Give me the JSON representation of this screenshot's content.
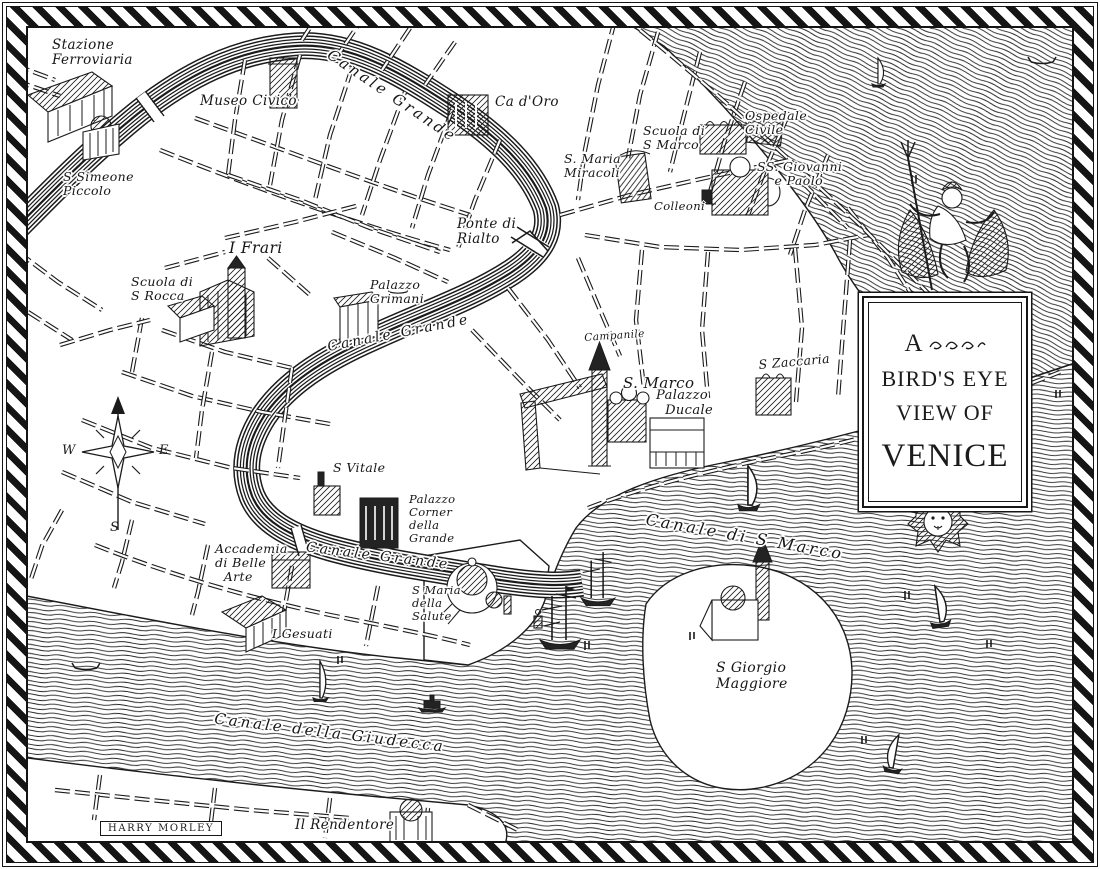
{
  "map": {
    "title_cartouche": {
      "line1": "A",
      "line2": "BIRD'S EYE",
      "line3": "VIEW OF",
      "line4": "VENICE"
    },
    "signature": "HARRY MORLEY",
    "compass": {
      "west": "W",
      "east": "E",
      "south": "S"
    },
    "colors": {
      "ink": "#1b1b1b",
      "paper": "#ffffff"
    },
    "labels": [
      {
        "id": "stazione-ferroviaria",
        "text": "Stazione\nFerroviaria",
        "x": 52,
        "y": 38,
        "size": 13.5
      },
      {
        "id": "museo-civico",
        "text": "Museo Civico",
        "x": 200,
        "y": 94,
        "size": 13.5
      },
      {
        "id": "ca-doro",
        "text": "Ca d'Oro",
        "x": 495,
        "y": 95,
        "size": 13.5
      },
      {
        "id": "scuola-di-s-marco",
        "text": "Scuola di\nS Marco",
        "x": 643,
        "y": 124,
        "size": 12.5
      },
      {
        "id": "ospedale-civile",
        "text": "Ospedale\nCivile",
        "x": 745,
        "y": 109,
        "size": 12.5
      },
      {
        "id": "s-maria-miracoli",
        "text": "S. Maria\nMiracoli",
        "x": 564,
        "y": 152,
        "size": 12.5
      },
      {
        "id": "ss-giovanni-e-paolo",
        "text": "SS. Giovanni\n    e Paolo",
        "x": 757,
        "y": 160,
        "size": 12.5
      },
      {
        "id": "colleoni",
        "text": "Colleoni",
        "x": 654,
        "y": 200,
        "size": 11.5
      },
      {
        "id": "s-simeone-piccolo",
        "text": "S Simeone\nPiccolo",
        "x": 63,
        "y": 170,
        "size": 12.5
      },
      {
        "id": "ponte-di-rialto",
        "text": "Ponte di\nRialto",
        "x": 457,
        "y": 217,
        "size": 13.5
      },
      {
        "id": "i-frari",
        "text": "I Frari",
        "x": 229,
        "y": 240,
        "size": 15.5
      },
      {
        "id": "scuola-di-s-rocca",
        "text": "Scuola di\nS Rocca",
        "x": 131,
        "y": 275,
        "size": 12.5
      },
      {
        "id": "palazzo-grimani",
        "text": "Palazzo\nGrimani",
        "x": 370,
        "y": 278,
        "size": 12.5
      },
      {
        "id": "canale-grande-upper",
        "text": "Canale Grande",
        "x": 392,
        "y": 96,
        "size": 15,
        "rotate": 34,
        "align": "center",
        "cls": "canal-name"
      },
      {
        "id": "canale-grande-middle",
        "text": "Canale Grande",
        "x": 399,
        "y": 334,
        "size": 14,
        "rotate": -11,
        "align": "center",
        "cls": "canal-name"
      },
      {
        "id": "campanile",
        "text": "Campanile",
        "x": 584,
        "y": 333,
        "size": 10.5,
        "rotate": -4
      },
      {
        "id": "s-marco",
        "text": "S. Marco",
        "x": 623,
        "y": 375,
        "size": 15
      },
      {
        "id": "palazzo-ducale",
        "text": "Palazzo\n  Ducale",
        "x": 656,
        "y": 389,
        "size": 13
      },
      {
        "id": "s-zaccaria",
        "text": "S Zaccaria",
        "x": 758,
        "y": 358,
        "size": 12.5,
        "rotate": -5
      },
      {
        "id": "s-vitale",
        "text": "S Vitale",
        "x": 333,
        "y": 461,
        "size": 12.5
      },
      {
        "id": "palazzo-corner-della-grande",
        "text": "Palazzo\nCorner\ndella\nGrande",
        "x": 409,
        "y": 493,
        "size": 11.5
      },
      {
        "id": "accademia-di-belle-arte",
        "text": "Accademia\ndi Belle\n  Arte",
        "x": 215,
        "y": 542,
        "size": 12.5
      },
      {
        "id": "canale-grande-lower",
        "text": "Canale Grande",
        "x": 378,
        "y": 557,
        "size": 14,
        "rotate": 7,
        "align": "center",
        "cls": "canal-name"
      },
      {
        "id": "s-maria-della-salute",
        "text": "S Maria\ndella\nSalute",
        "x": 412,
        "y": 584,
        "size": 11.5
      },
      {
        "id": "i-gesuati",
        "text": "I Gesuati",
        "x": 272,
        "y": 627,
        "size": 12.5
      },
      {
        "id": "canale-di-s-marco",
        "text": "Canale di S Marco",
        "x": 745,
        "y": 537,
        "size": 16,
        "rotate": 10,
        "align": "center",
        "cls": "canal-name"
      },
      {
        "id": "s-giorgio-maggiore",
        "text": "S Giorgio\nMaggiore",
        "x": 716,
        "y": 661,
        "size": 14
      },
      {
        "id": "canale-della-giudecca",
        "text": "Canale della Giudecca",
        "x": 330,
        "y": 733,
        "size": 15,
        "rotate": 7,
        "align": "center",
        "cls": "canal-name"
      },
      {
        "id": "il-rendentore",
        "text": "Il Rendentore",
        "x": 295,
        "y": 818,
        "size": 13.5
      }
    ]
  }
}
